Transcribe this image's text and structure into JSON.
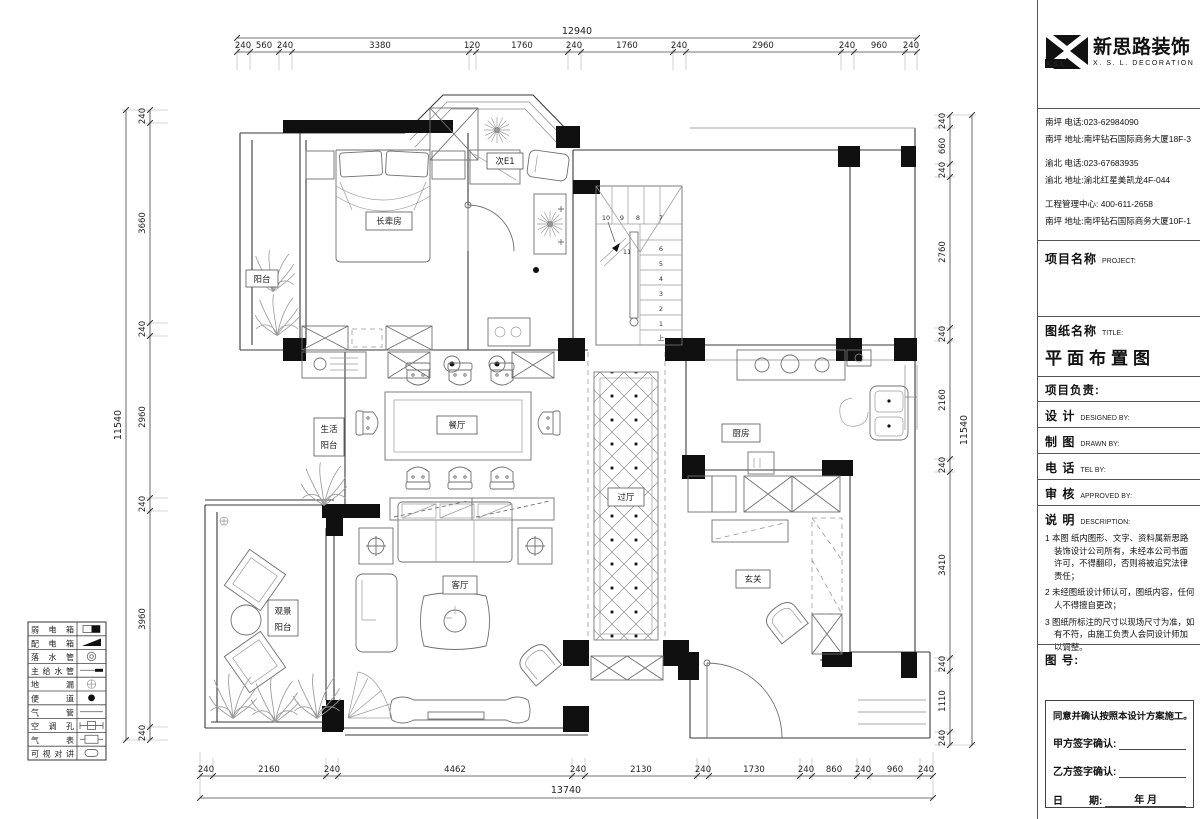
{
  "sheet": {
    "title": "平面布置图"
  },
  "brand": {
    "mark_text": "X.S.L",
    "company_cn": "新思路装饰",
    "company_en": "X. S. L. DECORATION"
  },
  "contact": {
    "lines": [
      "南坪  电话:023-62984090",
      "南坪  地址:南坪钻石国际商务大厦18F-3",
      "渝北  电话:023-67683935",
      "渝北  地址:渝北红星美凯龙4F-044",
      "工程管理中心: 400-611-2658",
      "南坪  地址:南坪钻石国际商务大厦10F-1"
    ]
  },
  "title_block": {
    "project_cn": "项目名称",
    "project_en": "PROJECT:",
    "drawing_cn": "图纸名称",
    "drawing_en": "TITLE:",
    "drawing_title": "平面布置图",
    "pm_label": "项目负责:",
    "design_cn": "设  计",
    "design_en": "DESIGNED BY:",
    "draft_cn": "制  图",
    "draft_en": "DRAWN BY:",
    "tel_cn": "电  话",
    "tel_en": "TEL BY:",
    "approve_cn": "审  核",
    "approve_en": "APPROVED BY:",
    "notes_cn": "说  明",
    "notes_en": "DESCRIPTION:",
    "notes": [
      "1 本图 纸内图形、文字、资料属新思路装饰设计公司所有，未经本公司书面许可，不得翻印，否则将被追究法律责任；",
      "2 未经图纸设计师认可，图纸内容，任何人不得擅自更改；",
      "3 图纸所标注的尺寸以现场尺寸为准，如有不符，由施工负责人会同设计师加以调整。"
    ],
    "fig_no_label": "图 号:",
    "sign_agree": "同意并确认按照本设计方案施工。",
    "sign_a": "甲方签字确认:",
    "sign_b": "乙方签字确认:",
    "date_l": "日",
    "date_r": "期:",
    "date_val": "年  月"
  },
  "legend": {
    "items": [
      {
        "label": "弱电箱"
      },
      {
        "label": "配电箱"
      },
      {
        "label": "落水管"
      },
      {
        "label": "主给水管"
      },
      {
        "label": "地漏"
      },
      {
        "label": "便道"
      },
      {
        "label": "气管"
      },
      {
        "label": "空调孔"
      },
      {
        "label": "气表"
      },
      {
        "label": "可视对讲"
      }
    ]
  },
  "rooms": {
    "balcony": "阳台",
    "master": "长辈房",
    "second": "次E1",
    "dining": "餐厅",
    "service_l1": "生活",
    "service_l2": "阳台",
    "hall": "过厅",
    "kitchen": "厨房",
    "living": "客厅",
    "view_l1": "观景",
    "view_l2": "阳台",
    "foyer": "玄关"
  },
  "stairs": {
    "up": "上",
    "numbers": [
      "1",
      "2",
      "3",
      "4",
      "5",
      "6",
      "7",
      "8",
      "9",
      "10",
      "11"
    ]
  },
  "dims": {
    "top": {
      "total": "12940",
      "segments": [
        "240",
        "560",
        "240",
        "3380",
        "120",
        "1760",
        "240",
        "1760",
        "240",
        "2960",
        "240",
        "960",
        "240"
      ]
    },
    "bottom": {
      "total": "13740",
      "segments": [
        "240",
        "2160",
        "240",
        "4462",
        "240",
        "2130",
        "240",
        "1730",
        "240",
        "860",
        "240",
        "960",
        "240"
      ]
    },
    "left": {
      "total": "11540",
      "segments": [
        "240",
        "3660",
        "240",
        "2960",
        "240",
        "3960",
        "240"
      ]
    },
    "right": {
      "total": "11540",
      "segments": [
        "240",
        "660",
        "240",
        "2760",
        "240",
        "2160",
        "240",
        "3410",
        "240",
        "1110",
        "240"
      ]
    }
  }
}
